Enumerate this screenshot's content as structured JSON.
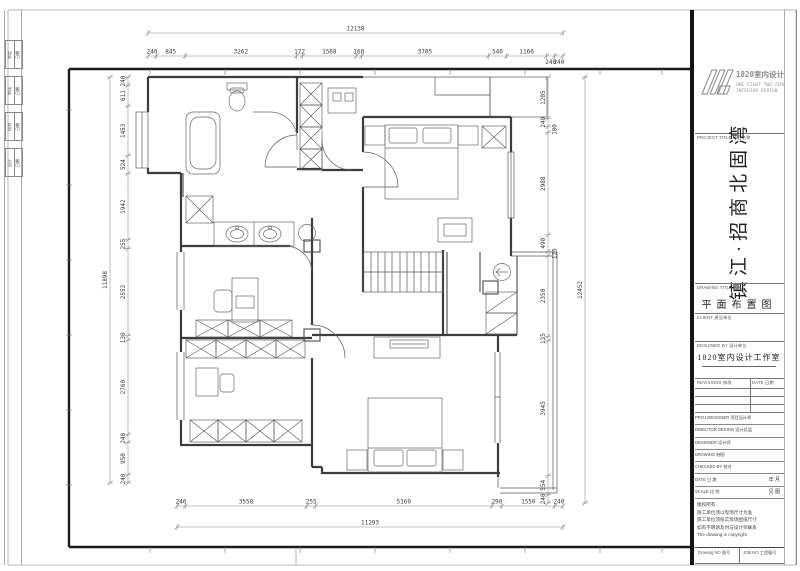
{
  "sheet": {
    "logo": {
      "cn": "1820室内设计",
      "en1": "ONE EIGHT TWO ZERO",
      "en2": "INTERIOR DESIGN"
    },
    "project_label": "PROJECT TITLE  项目名称",
    "project_title": "镇江·招商北固湾",
    "drawing_label": "DRAWING TITLE  图名",
    "drawing_title": "平面布置图",
    "client_label": "CLIENT  建设单位",
    "firm_label": "DESIGNED BY  设计单位",
    "firm_value": "1820室内设计工作室",
    "rev_label": "REVISIONS  修改",
    "rev_date_label": "DATE  日期",
    "staff_rows": [
      {
        "label": "PROJ.DESIGNER  项目设计师",
        "value": ""
      },
      {
        "label": "DIRECTOR DESIGN  设计总监",
        "value": ""
      },
      {
        "label": "DESIGNER  设计师",
        "value": ""
      },
      {
        "label": "DRAWING  制图",
        "value": ""
      },
      {
        "label": "CHECKED BY  校对",
        "value": ""
      },
      {
        "label": "DATE  日 期",
        "value": "年  月"
      },
      {
        "label": "SCALE  比 例",
        "value": "见  图"
      }
    ],
    "notes": [
      "版权所有",
      "施工单位须以现场尺寸为准",
      "施工单位须核实现场图纸尺寸",
      "如有不明请及时与设计师联系",
      "The drawing is copyright"
    ],
    "drawing_no_label": "Drawing NO  图号",
    "job_no_label": "JOB NO  工程编号",
    "sign_pairs": [
      {
        "a": "审定",
        "b": "日期"
      },
      {
        "a": "审核",
        "b": "日期"
      },
      {
        "a": "校对",
        "b": "日期"
      },
      {
        "a": "设计",
        "b": "日期"
      }
    ]
  },
  "dims": {
    "top_total": [
      12138
    ],
    "top": [
      240,
      845,
      3262,
      172,
      1568,
      160,
      3705,
      540,
      1166,
      240,
      240
    ],
    "left_total": [
      11898
    ],
    "left": [
      240,
      611,
      1453,
      524,
      1942,
      255,
      2553,
      130,
      2760,
      240,
      950,
      240
    ],
    "right": [
      1205,
      240,
      180,
      2988,
      490,
      125,
      2350,
      135,
      3945,
      554,
      240
    ],
    "right_total": [
      12452
    ],
    "bottom": [
      240,
      3558,
      255,
      5160,
      290,
      1550,
      240
    ],
    "bottom_total": [
      11293
    ]
  },
  "plan": {
    "fixtures": [
      "bathtub",
      "toilet",
      "shower",
      "twin-basin-vanity",
      "wardrobe-column",
      "bed",
      "nightstand",
      "desk",
      "chair",
      "stairs",
      "direction-circle",
      "tv-cabinet",
      "balcony-railing",
      "window",
      "door-arc"
    ]
  },
  "colors": {
    "wall": "#3c3c3c",
    "dim_line": "#8a8a8a",
    "dim_text": "#3a3a3a",
    "frame": "#1c1c1c",
    "paper": "#ffffff"
  }
}
